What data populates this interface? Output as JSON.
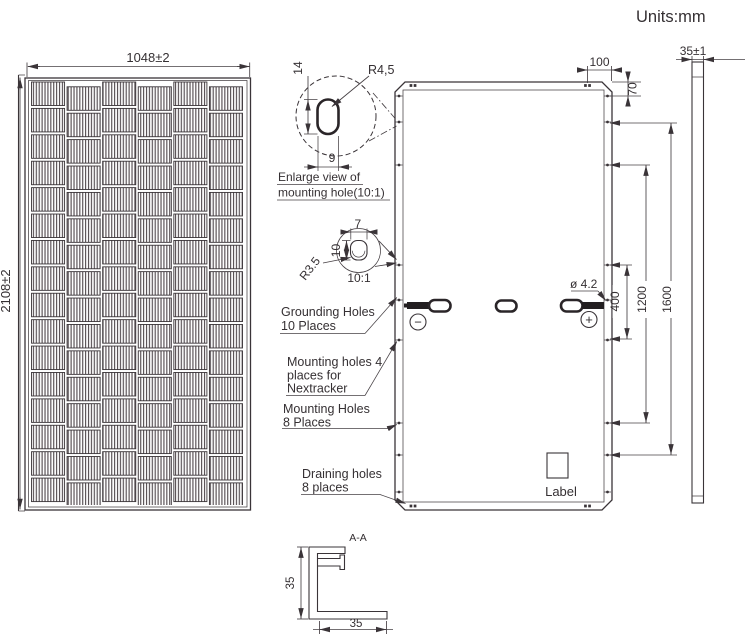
{
  "units_label": "Units:mm",
  "palette": {
    "line": "#3a3438",
    "background": "#ffffff"
  },
  "front_view": {
    "width_dim": "1048±2",
    "height_dim": "2108±2",
    "cell_grid": {
      "columns": 6,
      "rows": 16
    }
  },
  "back_view": {
    "dim_corner_offset": "100",
    "dim_top_hole": "70",
    "dim_grounding_span": "400",
    "dim_mounting_span": "1200",
    "dim_outer_mounting_span": "1600",
    "hole_diameter": "ø 4.2",
    "label_text": "Label",
    "negative_terminal": "−",
    "positive_terminal": "+"
  },
  "side_view": {
    "thickness_dim": "35±1"
  },
  "detail_mounting_hole": {
    "radius": "R4,5",
    "slot_height": "14",
    "slot_width": "9",
    "caption_line1": "Enlarge view of",
    "caption_line2": "mounting hole(10:1)"
  },
  "detail_grounding_hole": {
    "slot_width": "7",
    "slot_height": "10",
    "radius": "R3.5",
    "scale": "10:1"
  },
  "callouts": {
    "grounding": [
      "Grounding Holes",
      "10 Places"
    ],
    "nextracker": [
      "Mounting holes 4",
      "places for",
      "Nextracker"
    ],
    "mounting": [
      "Mounting Holes",
      "8 Places"
    ],
    "draining": [
      "Draining holes",
      "8 places"
    ]
  },
  "section": {
    "title": "A-A",
    "height_dim": "35",
    "width_dim": "35"
  }
}
